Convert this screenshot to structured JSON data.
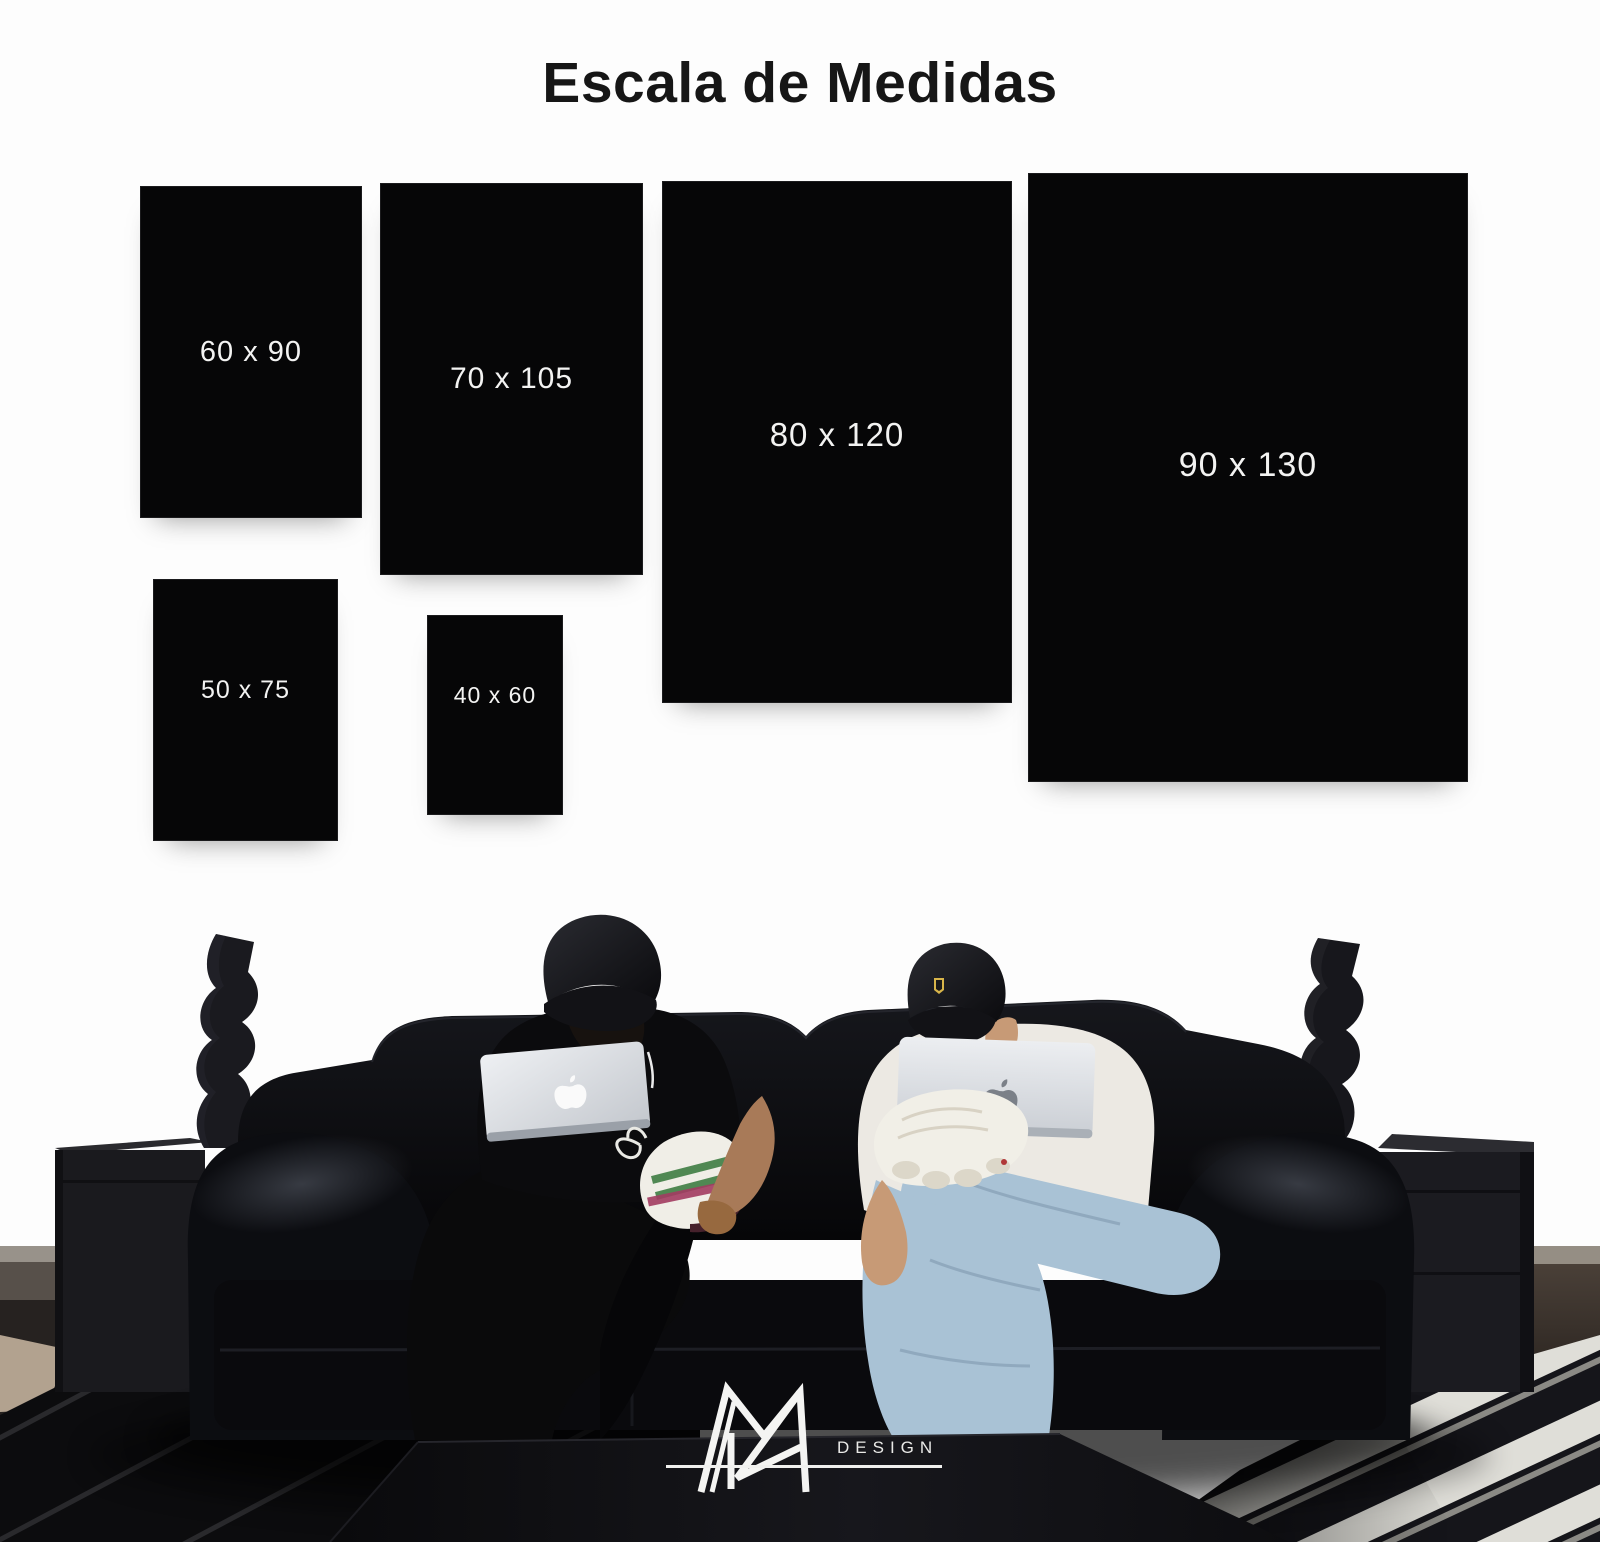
{
  "title": "Escala de Medidas",
  "size_chart": {
    "items": [
      {
        "id": "60x90",
        "label": "60 x 90",
        "width_cm": 60,
        "height_cm": 90
      },
      {
        "id": "70x105",
        "label": "70 x 105",
        "width_cm": 70,
        "height_cm": 105
      },
      {
        "id": "80x120",
        "label": "80 x 120",
        "width_cm": 80,
        "height_cm": 120
      },
      {
        "id": "90x130",
        "label": "90 x 130",
        "width_cm": 90,
        "height_cm": 130
      },
      {
        "id": "50x75",
        "label": "50 x 75",
        "width_cm": 50,
        "height_cm": 75
      },
      {
        "id": "40x60",
        "label": "40 x 60",
        "width_cm": 40,
        "height_cm": 60
      }
    ]
  },
  "brand": {
    "monogram": "MR",
    "wordmark": "DESIGN"
  },
  "icons": {
    "laptop_brand": "apple-logo",
    "cap_badge": "shield-crest-icon",
    "decor": "twisted-sculpture"
  },
  "colors": {
    "wall": "#fdfdfd",
    "panel": "#060607",
    "panel_text": "#f3f3f2",
    "title_text": "#161616",
    "couch": "#0a0b0e",
    "denim": "#a9c2d5",
    "shirt_white": "#ece9e3",
    "rug_stripe": "#dfded8",
    "logo_white": "#f4f4f2"
  }
}
